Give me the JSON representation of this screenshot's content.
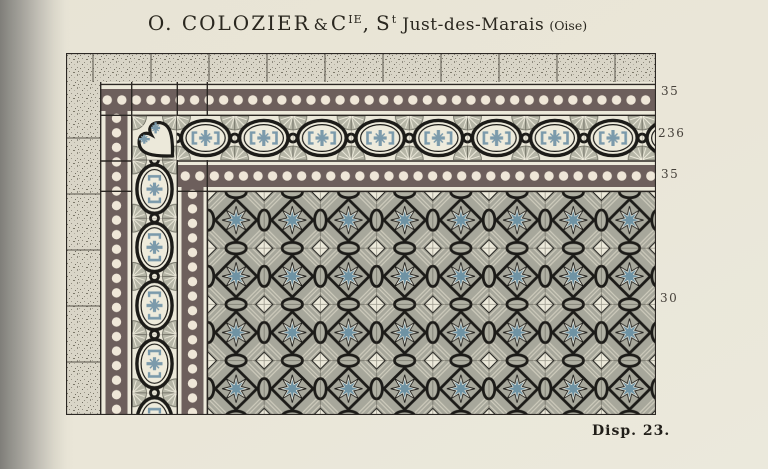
{
  "title": {
    "company": "O. COLOZIER",
    "amp": "&",
    "cie_base": "C",
    "cie_sup": "IE",
    "separator": ",",
    "saint_base": "S",
    "saint_sup": "t",
    "place": "Just-des-Marais",
    "region": "(Oise)"
  },
  "dimension_labels": [
    "35",
    "236",
    "35",
    "30"
  ],
  "caption": "Disp. 23.",
  "colors": {
    "page_background": "#e9e5d6",
    "gutter_shadow": "#7f7e79",
    "stone_tile": "#d9d5c7",
    "band_dark": "#6d5f5c",
    "dot_cream": "#efe7d8",
    "frieze_cream": "#ebe8d9",
    "ornament_blue": "#7b9aab",
    "palmette_gray": "#b5b5a6",
    "field_gray": "#a7a79b",
    "hatch_light": "#cfccbd",
    "outline_black": "#1c1b18",
    "ink": "#2a271f"
  }
}
